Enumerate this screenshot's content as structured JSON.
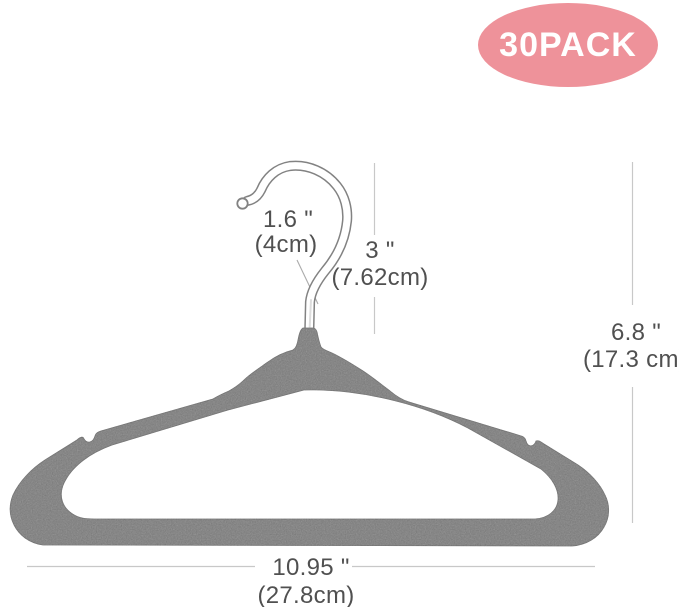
{
  "badge": {
    "label": "30PACK"
  },
  "product": {
    "kind": "velvet suit hanger"
  },
  "dimensions": {
    "hook_opening": {
      "inches": "1.6 \"",
      "metric": "(4cm)"
    },
    "hook_height": {
      "inches": "3 \"",
      "metric": "(7.62cm)"
    },
    "overall_height": {
      "inches": "6.8 \"",
      "metric": "(17.3 cm)"
    },
    "overall_width": {
      "inches": "10.95 \"",
      "metric": "(27.8cm)"
    }
  },
  "colors": {
    "background": "#ffffff",
    "hanger_body": "#a2a2a2",
    "hook_outline": "#828282",
    "dimension_line": "#c8c8c8",
    "leader_line": "#ababab",
    "dimension_text": "#505050",
    "badge_bg": "#ee929a",
    "badge_text": "#ffffff"
  }
}
